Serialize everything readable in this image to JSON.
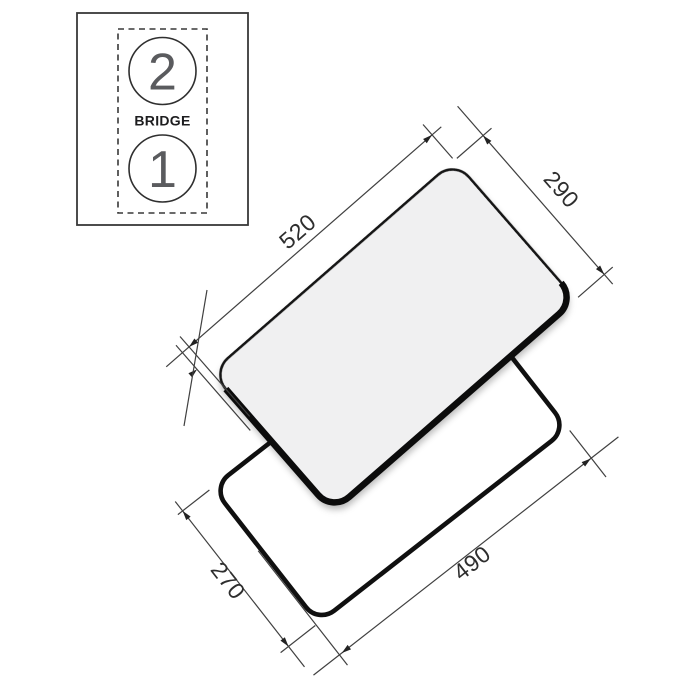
{
  "diagram": {
    "title_hint": "cooktop-installation-dimensions",
    "inset": {
      "zone_top_label": "2",
      "zone_bottom_label": "1",
      "bridge_label": "BRIDGE"
    },
    "dims": {
      "glass_width": "520",
      "glass_depth": "290",
      "cutout_depth": "270",
      "cutout_width": "490"
    },
    "colors": {
      "line": "#404040",
      "heavy_line": "#101010",
      "glass_fill": "#f0f0f1",
      "label": "#2e2e2e"
    }
  }
}
